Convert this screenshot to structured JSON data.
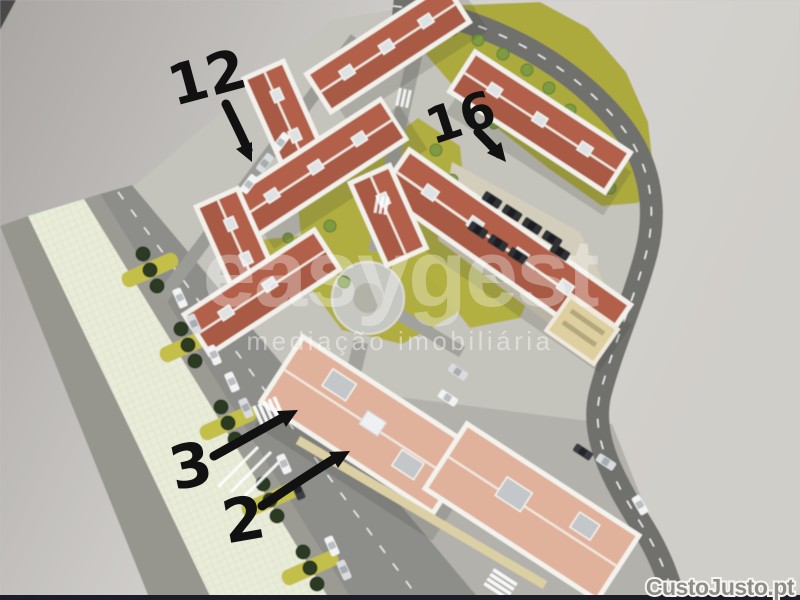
{
  "image": {
    "kind": "aerial 3D render of a residential development site plan (maquette)"
  },
  "watermark": {
    "brand": "easygest",
    "tagline": "mediação imobiliária"
  },
  "annotations": {
    "building_12": {
      "label": "12"
    },
    "building_16": {
      "label": "16"
    },
    "building_3": {
      "label": "3"
    },
    "building_2": {
      "label": "2"
    }
  },
  "footer_logo": {
    "text": "CustoJusto.pt"
  },
  "colors": {
    "background_gray": "#d2d0cc",
    "park_green": "#adab3d",
    "roof_terracotta": "#b2604a",
    "flat_roof_salmon": "#e0b29c",
    "road_dark": "#6f706d",
    "promenade_light": "#e9ecd8",
    "annotation_black": "#111111",
    "watermark_white": "#ffffff",
    "logo_gray": "#8e8c87"
  }
}
